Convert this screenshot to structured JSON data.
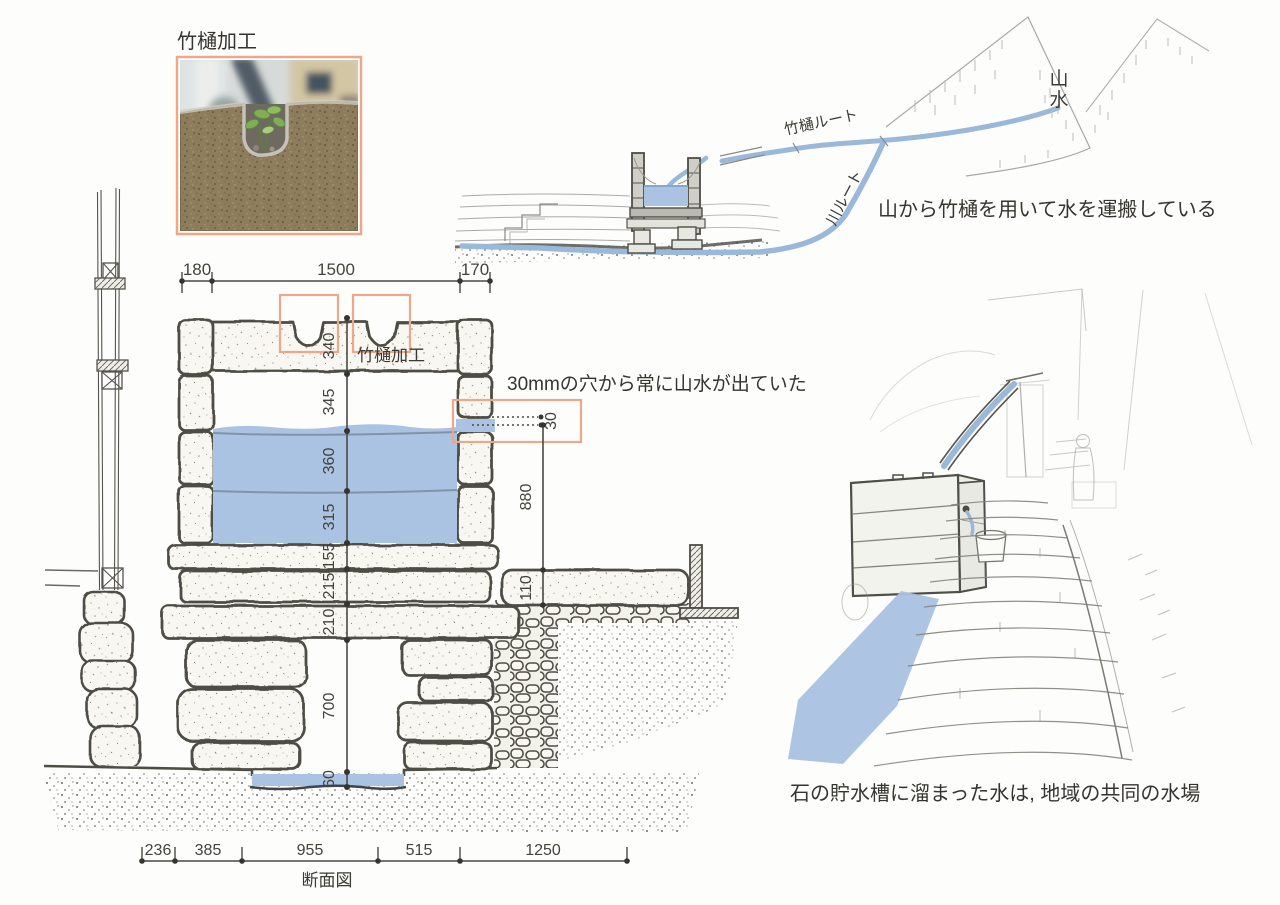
{
  "colors": {
    "water": "#aac3e2",
    "pipe_blue": "#9ab8da",
    "highlight_orange": "#efa78a",
    "ink": "#4e4d45",
    "sketch_gray": "#8f8f8a"
  },
  "photo": {
    "caption": "竹樋加工"
  },
  "section": {
    "title": "断面図",
    "notch_label": "竹樋加工",
    "hole_note": "30mmの穴から常に山水が出ていた",
    "dims_top": [
      "180",
      "1500",
      "170"
    ],
    "dims_left": [
      "340",
      "345",
      "360",
      "315",
      "155",
      "215",
      "210",
      "700",
      "60"
    ],
    "dim_hole": "30",
    "dim_height": "880",
    "dim_slab": "110",
    "dims_bottom": [
      "236",
      "385",
      "955",
      "515",
      "1250"
    ]
  },
  "route": {
    "mountain_chars": [
      "山",
      "水"
    ],
    "bamboo_label": "竹樋ルート",
    "river_label": "川ルート",
    "caption": "山から竹樋を用いて水を運搬している"
  },
  "pool": {
    "caption": "石の貯水槽に溜まった水は, 地域の共同の水場"
  }
}
